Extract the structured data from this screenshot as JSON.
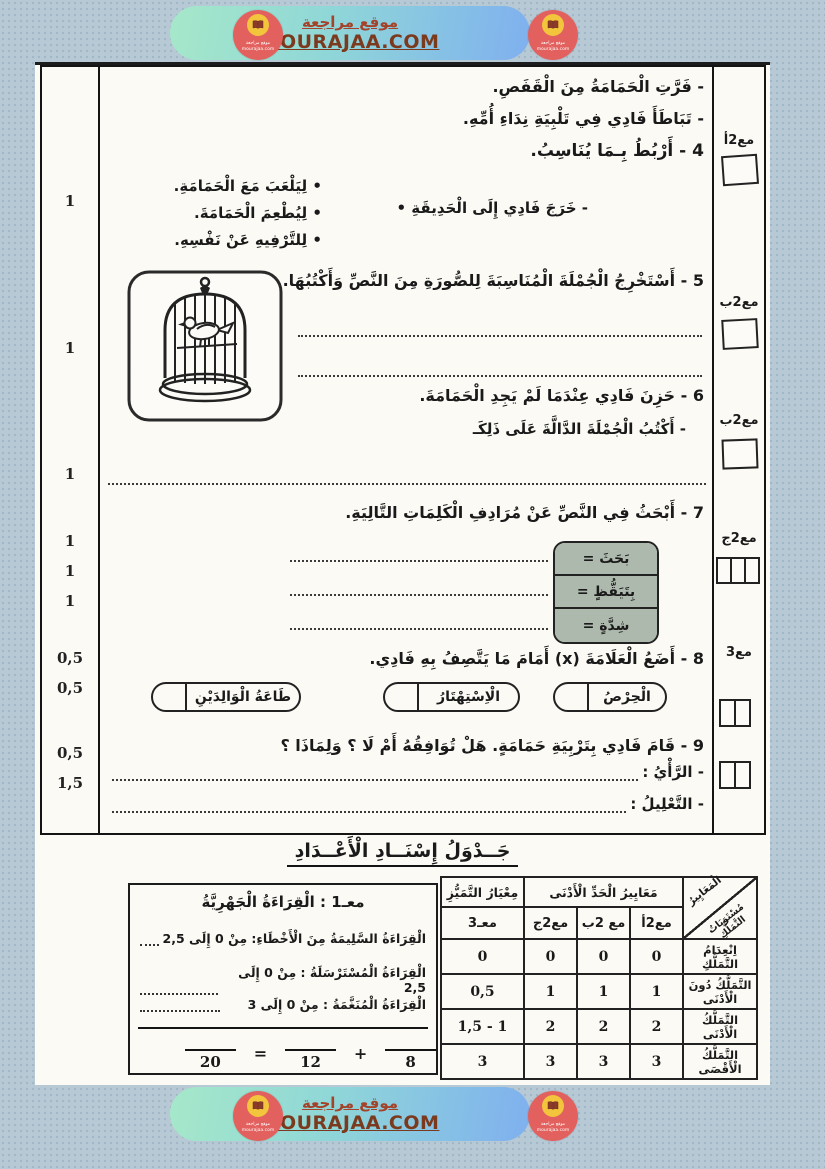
{
  "banner": {
    "title_ar": "موقع مراجعة",
    "url": "MOURAJAA.COM",
    "logo": {
      "line1": "موقع مراجعة",
      "line2": "mourajaa.com"
    },
    "colors": {
      "circle": "#e2615e",
      "inner_circle": "#f2c53d",
      "text": "#8c4a2f",
      "pill_green": "#a6e8c9",
      "pill_blue": "#7fb0ef"
    }
  },
  "scores": [
    "1",
    "1",
    "1",
    "1",
    "1",
    "1",
    "0,5",
    "0,5",
    "0,5",
    "1,5"
  ],
  "margin_marks": {
    "q4": "مع2أ",
    "q5": "مع2ب",
    "q6": "مع2ب",
    "q7": "مع2ج",
    "q8": "مع3"
  },
  "exercise": {
    "intro1": "- فَرَّتِ الْحَمَامَةُ مِنَ الْقَفَصِ.",
    "intro2": "- تَبَاطَأَ فَادِي فِي تَلْبِيَةِ نِدَاءِ أُمِّهِ.",
    "q4": {
      "title": "4 - أَرْبُطُ بِـمَا يُنَاسِبُ.",
      "right_item": "- خَرَجَ فَادِي إِلَى الْحَدِيقَةِ •",
      "options": [
        "• لِيَلْعَبَ مَعَ الْحَمَامَةِ.",
        "• لِيُطْعِمَ الْحَمَامَةَ.",
        "• لِلتَّرْفِيهِ عَنْ نَفْسِهِ."
      ]
    },
    "q5": {
      "title": "5 - أَسْتَخْرِجُ الْجُمْلَةَ الْمُنَاسِبَةَ لِلصُّورَةِ مِنَ النَّصِّ وَأَكْتُبُهَا."
    },
    "q6": {
      "title": "6 - حَزِنَ فَادِي عِنْدَمَا لَمْ يَجِدِ الْحَمَامَةَ.",
      "subtitle": "- أَكْتُبُ الْجُمْلَةَ الدَّالَّةَ عَلَى ذَلِكَـ"
    },
    "q7": {
      "title": "7 - أَبْحَثُ فِي النَّصِّ عَنْ مُرَادِفِ الْكَلِمَاتِ التَّالِيَةِ.",
      "words": [
        "بَحَثَ =",
        "بِتَيَقُّظٍ =",
        "شِدَّةٍ ="
      ]
    },
    "q8": {
      "title": "8 - أَضَعُ الْعَلَامَةَ (x) أَمَامَ مَا يَتَّصِفُ بِهِ فَادِي.",
      "options": [
        "الْحِرْصُ",
        "الْاِسْتِهْتَارُ",
        "طَاعَةُ الْوَالِدَيْنِ"
      ]
    },
    "q9": {
      "title": "9 - قَامَ فَادِي بِتَرْبِيَةِ حَمَامَةٍ. هَلْ تُوَافِقُهُ أَمْ لَا ؟ وَلِمَاذَا ؟",
      "line1": "- الرَّأْيُ :",
      "line2": "- التَّعْلِيلُ :"
    }
  },
  "grading": {
    "title": "جَــدْوَلُ إِسْنَــادِ الْأَعْــدَادِ",
    "reading_box": {
      "header": "معـ1 :  الْقِرَاءَةُ الْجَهْرِيَّةُ",
      "line1": "الْقِرَاءَةُ السَّلِيمَةُ مِنَ الْأَخْطَاءِ: مِنْ 0 إِلَى 2,5",
      "line2": "الْقِرَاءَةُ الْمُسْتَرْسَلَةُ : مِنْ 0 إِلَى 2,5",
      "line3": "الْقِرَاءَةُ الْمُنَغَّمَةُ : مِنْ 0 إِلَى 3",
      "fraction": {
        "den_total": "20",
        "den_left": "12",
        "den_right": "8",
        "eq": "=",
        "plus": "+"
      }
    },
    "table": {
      "diag_top": "الْمَعَايِيرُ",
      "diag_bottom": "مُسْتَوَيَاتُ التَّمَلُّكِ",
      "min_group": "مَعَايِيرُ الْحَدِّ الْأَدْنَى",
      "excellence": "مِعْيَارُ التَّمَيُّزِ",
      "cols": [
        "مع2أ",
        "مع 2ب",
        "مع2ج",
        "معـ3"
      ],
      "rows": [
        {
          "label": "اِنْعِدَامُ التَّمَلُّكِ",
          "v1": "0",
          "v2": "0",
          "v3": "0",
          "v4": "0"
        },
        {
          "label": "التَّمَلُّكُ دُونَ الْأَدْنَى",
          "v1": "1",
          "v2": "1",
          "v3": "1",
          "v4": "0,5"
        },
        {
          "label": "التَّمَلُّكُ الْأَدْنَى",
          "v1": "2",
          "v2": "2",
          "v3": "2",
          "v4": "1,5 - 1"
        },
        {
          "label": "التَّمَلُّكُ الْأَقْصَى",
          "v1": "3",
          "v2": "3",
          "v3": "3",
          "v4": "3"
        }
      ]
    }
  }
}
